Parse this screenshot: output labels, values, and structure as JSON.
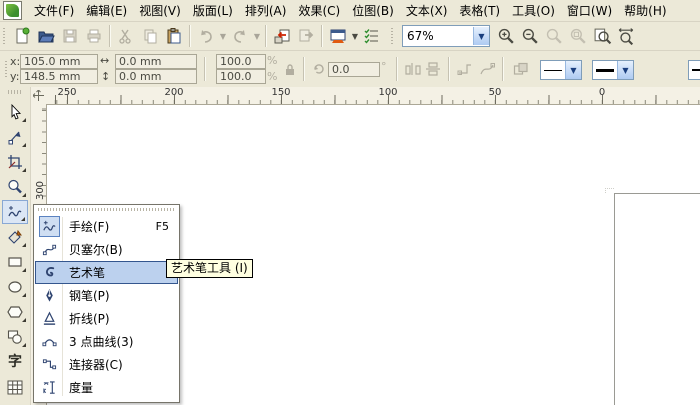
{
  "colors": {
    "window_bg": "#ece9d8",
    "highlight_bg": "#bcd1ee",
    "highlight_border": "#34568e",
    "tooltip_bg": "#ffffe1",
    "canvas_bg": "#ffffff",
    "accent_blue": "#316ac5"
  },
  "menubar": {
    "items": [
      "文件(F)",
      "编辑(E)",
      "视图(V)",
      "版面(L)",
      "排列(A)",
      "效果(C)",
      "位图(B)",
      "文本(X)",
      "表格(T)",
      "工具(O)",
      "窗口(W)",
      "帮助(H)"
    ]
  },
  "toolbar": {
    "zoom_level": "67%",
    "icons": [
      "new-document-icon",
      "open-folder-icon",
      "save-icon",
      "print-icon",
      "cut-icon",
      "copy-icon",
      "paste-icon",
      "undo-icon",
      "redo-icon",
      "import-icon",
      "export-icon",
      "app-launcher-icon",
      "options-icon",
      "zoom-in-icon",
      "zoom-out-icon",
      "zoom-actual-icon",
      "zoom-selected-icon",
      "zoom-page-icon",
      "zoom-width-icon"
    ]
  },
  "property_bar": {
    "x_label": "x:",
    "x_value": "105.0 mm",
    "y_label": "y:",
    "y_value": "148.5 mm",
    "width_value": "0.0 mm",
    "height_value": "0.0 mm",
    "scale_h": "100.0",
    "scale_v": "100.0",
    "percent_h": "%",
    "percent_v": "%",
    "rotation_value": "0.0",
    "degree_symbol": "°"
  },
  "rulers": {
    "horizontal": [
      "250",
      "200",
      "150",
      "100",
      "50",
      "0"
    ],
    "vertical": [
      "300"
    ]
  },
  "toolbox": {
    "tools": [
      "pick-tool",
      "shape-tool",
      "crop-tool",
      "zoom-tool",
      "freehand-tool",
      "smart-fill-tool",
      "rectangle-tool",
      "ellipse-tool",
      "polygon-tool",
      "basic-shapes-tool",
      "text-tool",
      "table-tool"
    ],
    "active_index": 4
  },
  "flyout_menu": {
    "items": [
      {
        "label": "手绘(F)",
        "shortcut": "F5"
      },
      {
        "label": "贝塞尔(B)",
        "shortcut": ""
      },
      {
        "label": "艺术笔",
        "shortcut": "I"
      },
      {
        "label": "钢笔(P)",
        "shortcut": ""
      },
      {
        "label": "折线(P)",
        "shortcut": ""
      },
      {
        "label": "3 点曲线(3)",
        "shortcut": ""
      },
      {
        "label": "连接器(C)",
        "shortcut": ""
      },
      {
        "label": "度量",
        "shortcut": ""
      }
    ],
    "highlighted_index": 2
  },
  "tooltip": {
    "text": "艺术笔工具 (I)"
  }
}
